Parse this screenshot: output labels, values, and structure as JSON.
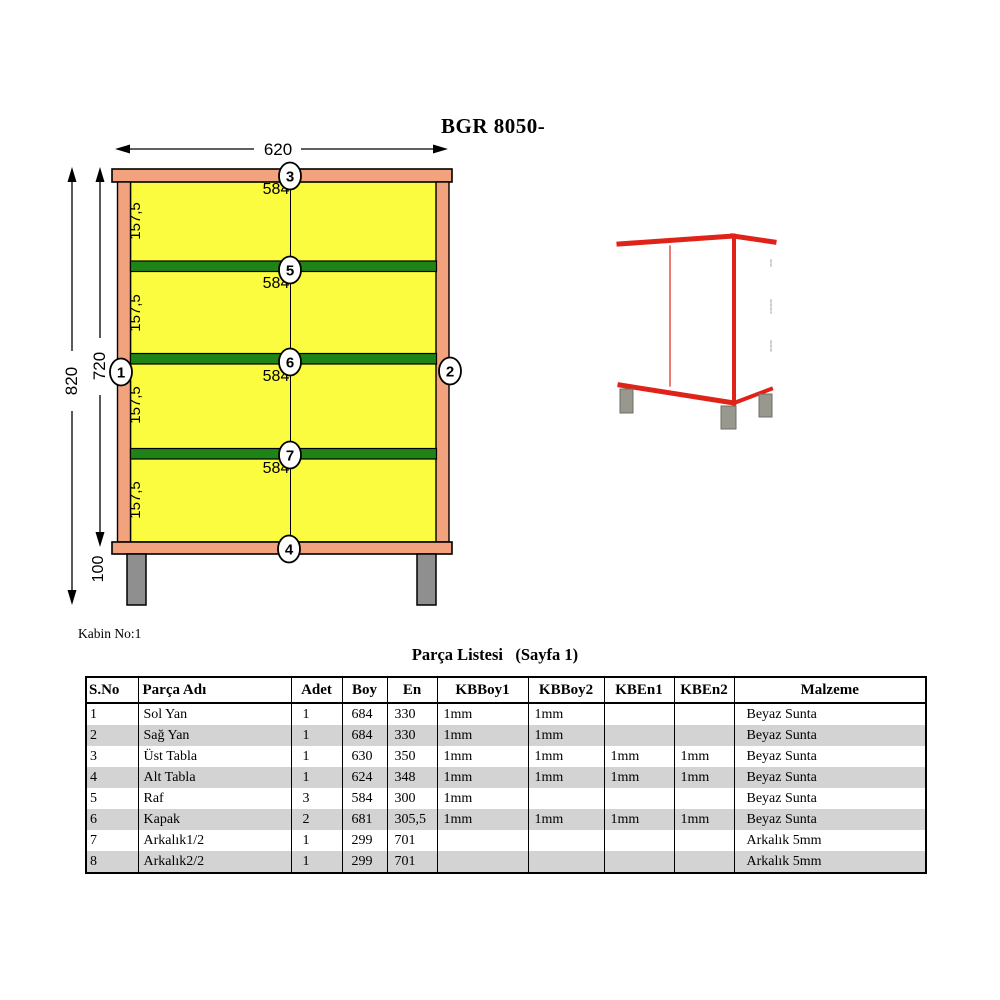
{
  "title": "BGR 8050-",
  "drawing": {
    "caption": "Kabin No:1",
    "dimensions": {
      "width": "620",
      "total_height": "820",
      "body_height": "720",
      "leg_height": "100",
      "section_height": "157,5",
      "shelf_width": "584"
    },
    "balloons": [
      "1",
      "2",
      "3",
      "4",
      "5",
      "6",
      "7"
    ],
    "colors": {
      "frame": "#F2A27D",
      "panel": "#FBFB3F",
      "shelf": "#1E8418",
      "leg": "#8F8F8F",
      "outline_3d": "#E02318",
      "leg_3d": "#98988F"
    }
  },
  "table": {
    "title": "Parça Listesi   (Sayfa 1)",
    "headers": [
      "S.No",
      "Parça Adı",
      "Adet",
      "Boy",
      "En",
      "KBBoy1",
      "KBBoy2",
      "KBEn1",
      "KBEn2",
      "Malzeme"
    ],
    "rows": [
      [
        "1",
        "Sol Yan",
        "1",
        "684",
        "330",
        "1mm",
        "1mm",
        "",
        "",
        "Beyaz Sunta"
      ],
      [
        "2",
        "Sağ Yan",
        "1",
        "684",
        "330",
        "1mm",
        "1mm",
        "",
        "",
        "Beyaz Sunta"
      ],
      [
        "3",
        "Üst Tabla",
        "1",
        "630",
        "350",
        "1mm",
        "1mm",
        "1mm",
        "1mm",
        "Beyaz Sunta"
      ],
      [
        "4",
        "Alt Tabla",
        "1",
        "624",
        "348",
        "1mm",
        "1mm",
        "1mm",
        "1mm",
        "Beyaz Sunta"
      ],
      [
        "5",
        "Raf",
        "3",
        "584",
        "300",
        "1mm",
        "",
        "",
        "",
        "Beyaz Sunta"
      ],
      [
        "6",
        "Kapak",
        "2",
        "681",
        "305,5",
        "1mm",
        "1mm",
        "1mm",
        "1mm",
        "Beyaz Sunta"
      ],
      [
        "7",
        "Arkalık1/2",
        "1",
        "299",
        "701",
        "",
        "",
        "",
        "",
        "Arkalık 5mm"
      ],
      [
        "8",
        "Arkalık2/2",
        "1",
        "299",
        "701",
        "",
        "",
        "",
        "",
        "Arkalık 5mm"
      ]
    ],
    "stripe_color": "#D3D3D3"
  }
}
